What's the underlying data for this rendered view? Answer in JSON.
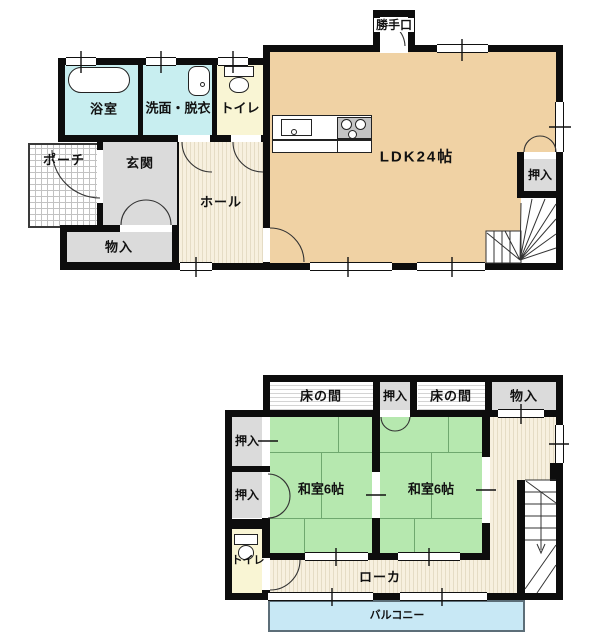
{
  "floor1": {
    "backdoor": "勝手口",
    "bath": "浴室",
    "washroom": "洗面・脱衣",
    "toilet": "トイレ",
    "porch": "ポーチ",
    "entrance": "玄関",
    "hall": "ホール",
    "storage": "物入",
    "ldk": "LDK24帖",
    "closet": "押入"
  },
  "floor2": {
    "tokonoma_left": "床の間",
    "closet_center": "押入",
    "tokonoma_right": "床の間",
    "storage": "物入",
    "closet_upper": "押入",
    "closet_lower": "押入",
    "washitsu_left": "和室6帖",
    "washitsu_right": "和室6帖",
    "toilet": "トイレ",
    "corridor": "ローカ",
    "balcony": "バルコニー"
  },
  "colors": {
    "ldk": "#f0d2a4",
    "wet_rooms": "#c8eef0",
    "toilet": "#f9f5d4",
    "closet": "#dbdbdb",
    "tatami": "#b6e8af",
    "balcony": "#c8e8f5",
    "wall": "#0d0d0d",
    "hall_stripe_base": "#f7f0df"
  }
}
